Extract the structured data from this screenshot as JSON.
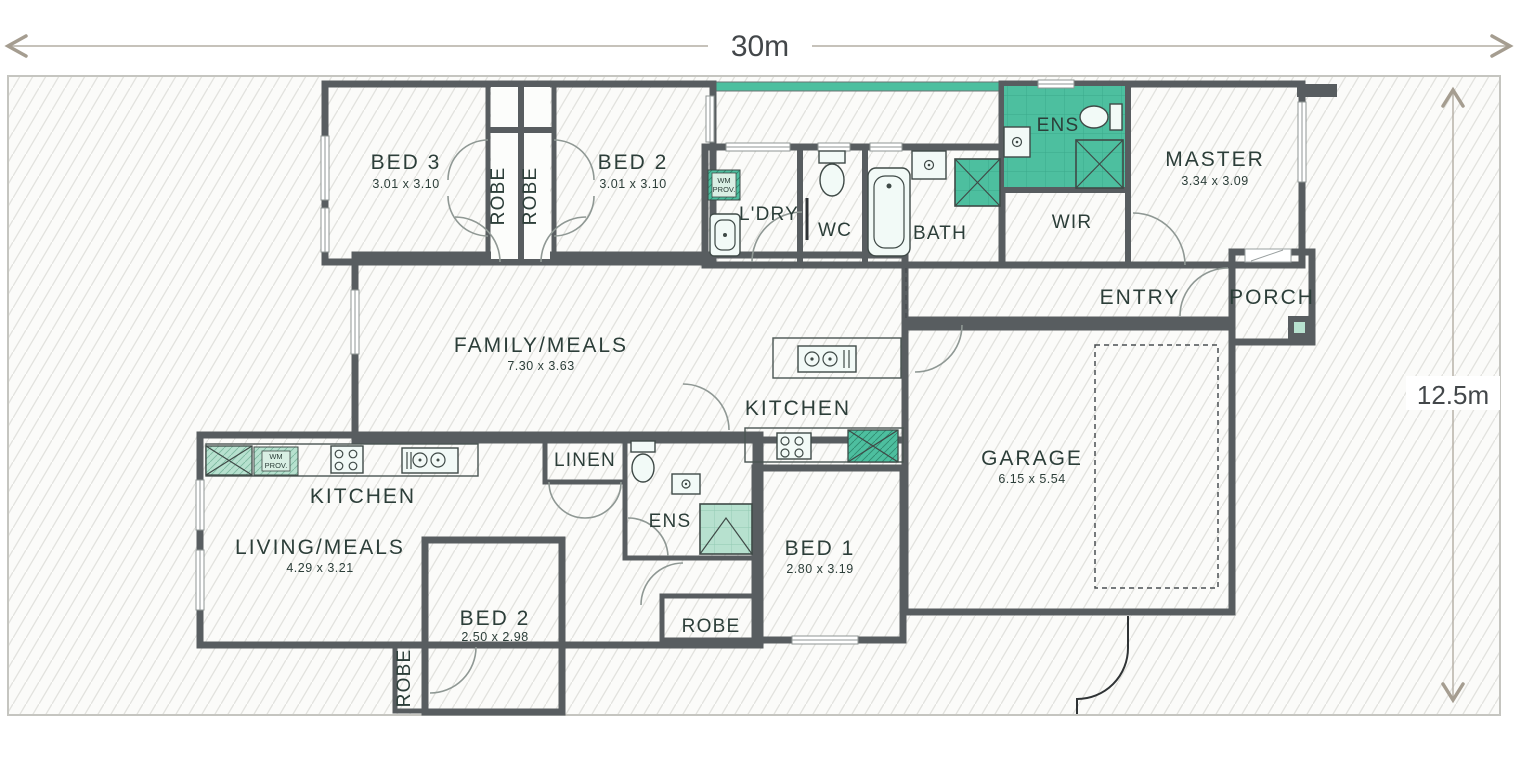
{
  "site": {
    "width_label": "30m",
    "depth_label": "12.5m"
  },
  "rooms": {
    "bed3": {
      "label": "BED 3",
      "size": "3.01 x 3.10"
    },
    "bed2_upper": {
      "label": "BED 2",
      "size": "3.01 x 3.10"
    },
    "robe_bed3": {
      "label": "ROBE"
    },
    "robe_bed2": {
      "label": "ROBE"
    },
    "ldry": {
      "label": "L'DRY"
    },
    "wc": {
      "label": "WC"
    },
    "bath": {
      "label": "BATH"
    },
    "ens_upper": {
      "label": "ENS"
    },
    "wir": {
      "label": "WIR"
    },
    "master": {
      "label": "MASTER",
      "size": "3.34 x 3.09"
    },
    "family": {
      "label": "FAMILY/MEALS",
      "size": "7.30 x 3.63"
    },
    "kitchen_upper": {
      "label": "KITCHEN"
    },
    "entry": {
      "label": "ENTRY"
    },
    "porch": {
      "label": "PORCH"
    },
    "garage": {
      "label": "GARAGE",
      "size": "6.15 x 5.54"
    },
    "kitchen_lower": {
      "label": "KITCHEN"
    },
    "living": {
      "label": "LIVING/MEALS",
      "size": "4.29 x 3.21"
    },
    "linen": {
      "label": "LINEN"
    },
    "ens_lower": {
      "label": "ENS"
    },
    "bed1": {
      "label": "BED 1",
      "size": "2.80 x 3.19"
    },
    "bed2_lower": {
      "label": "BED 2",
      "size": "2.50 x 2.98"
    },
    "robe_bed1": {
      "label": "ROBE"
    },
    "robe_bed2_lower": {
      "label": "ROBE"
    }
  },
  "annotations": {
    "wm_line1": "WM",
    "wm_line2": "PROV."
  },
  "colors": {
    "upper_dwelling_fill": "#4dbf9f",
    "lower_dwelling_fill": "#b7e1cf",
    "wall": "#585d60",
    "lot_hatch_line": "#e2e2de"
  }
}
